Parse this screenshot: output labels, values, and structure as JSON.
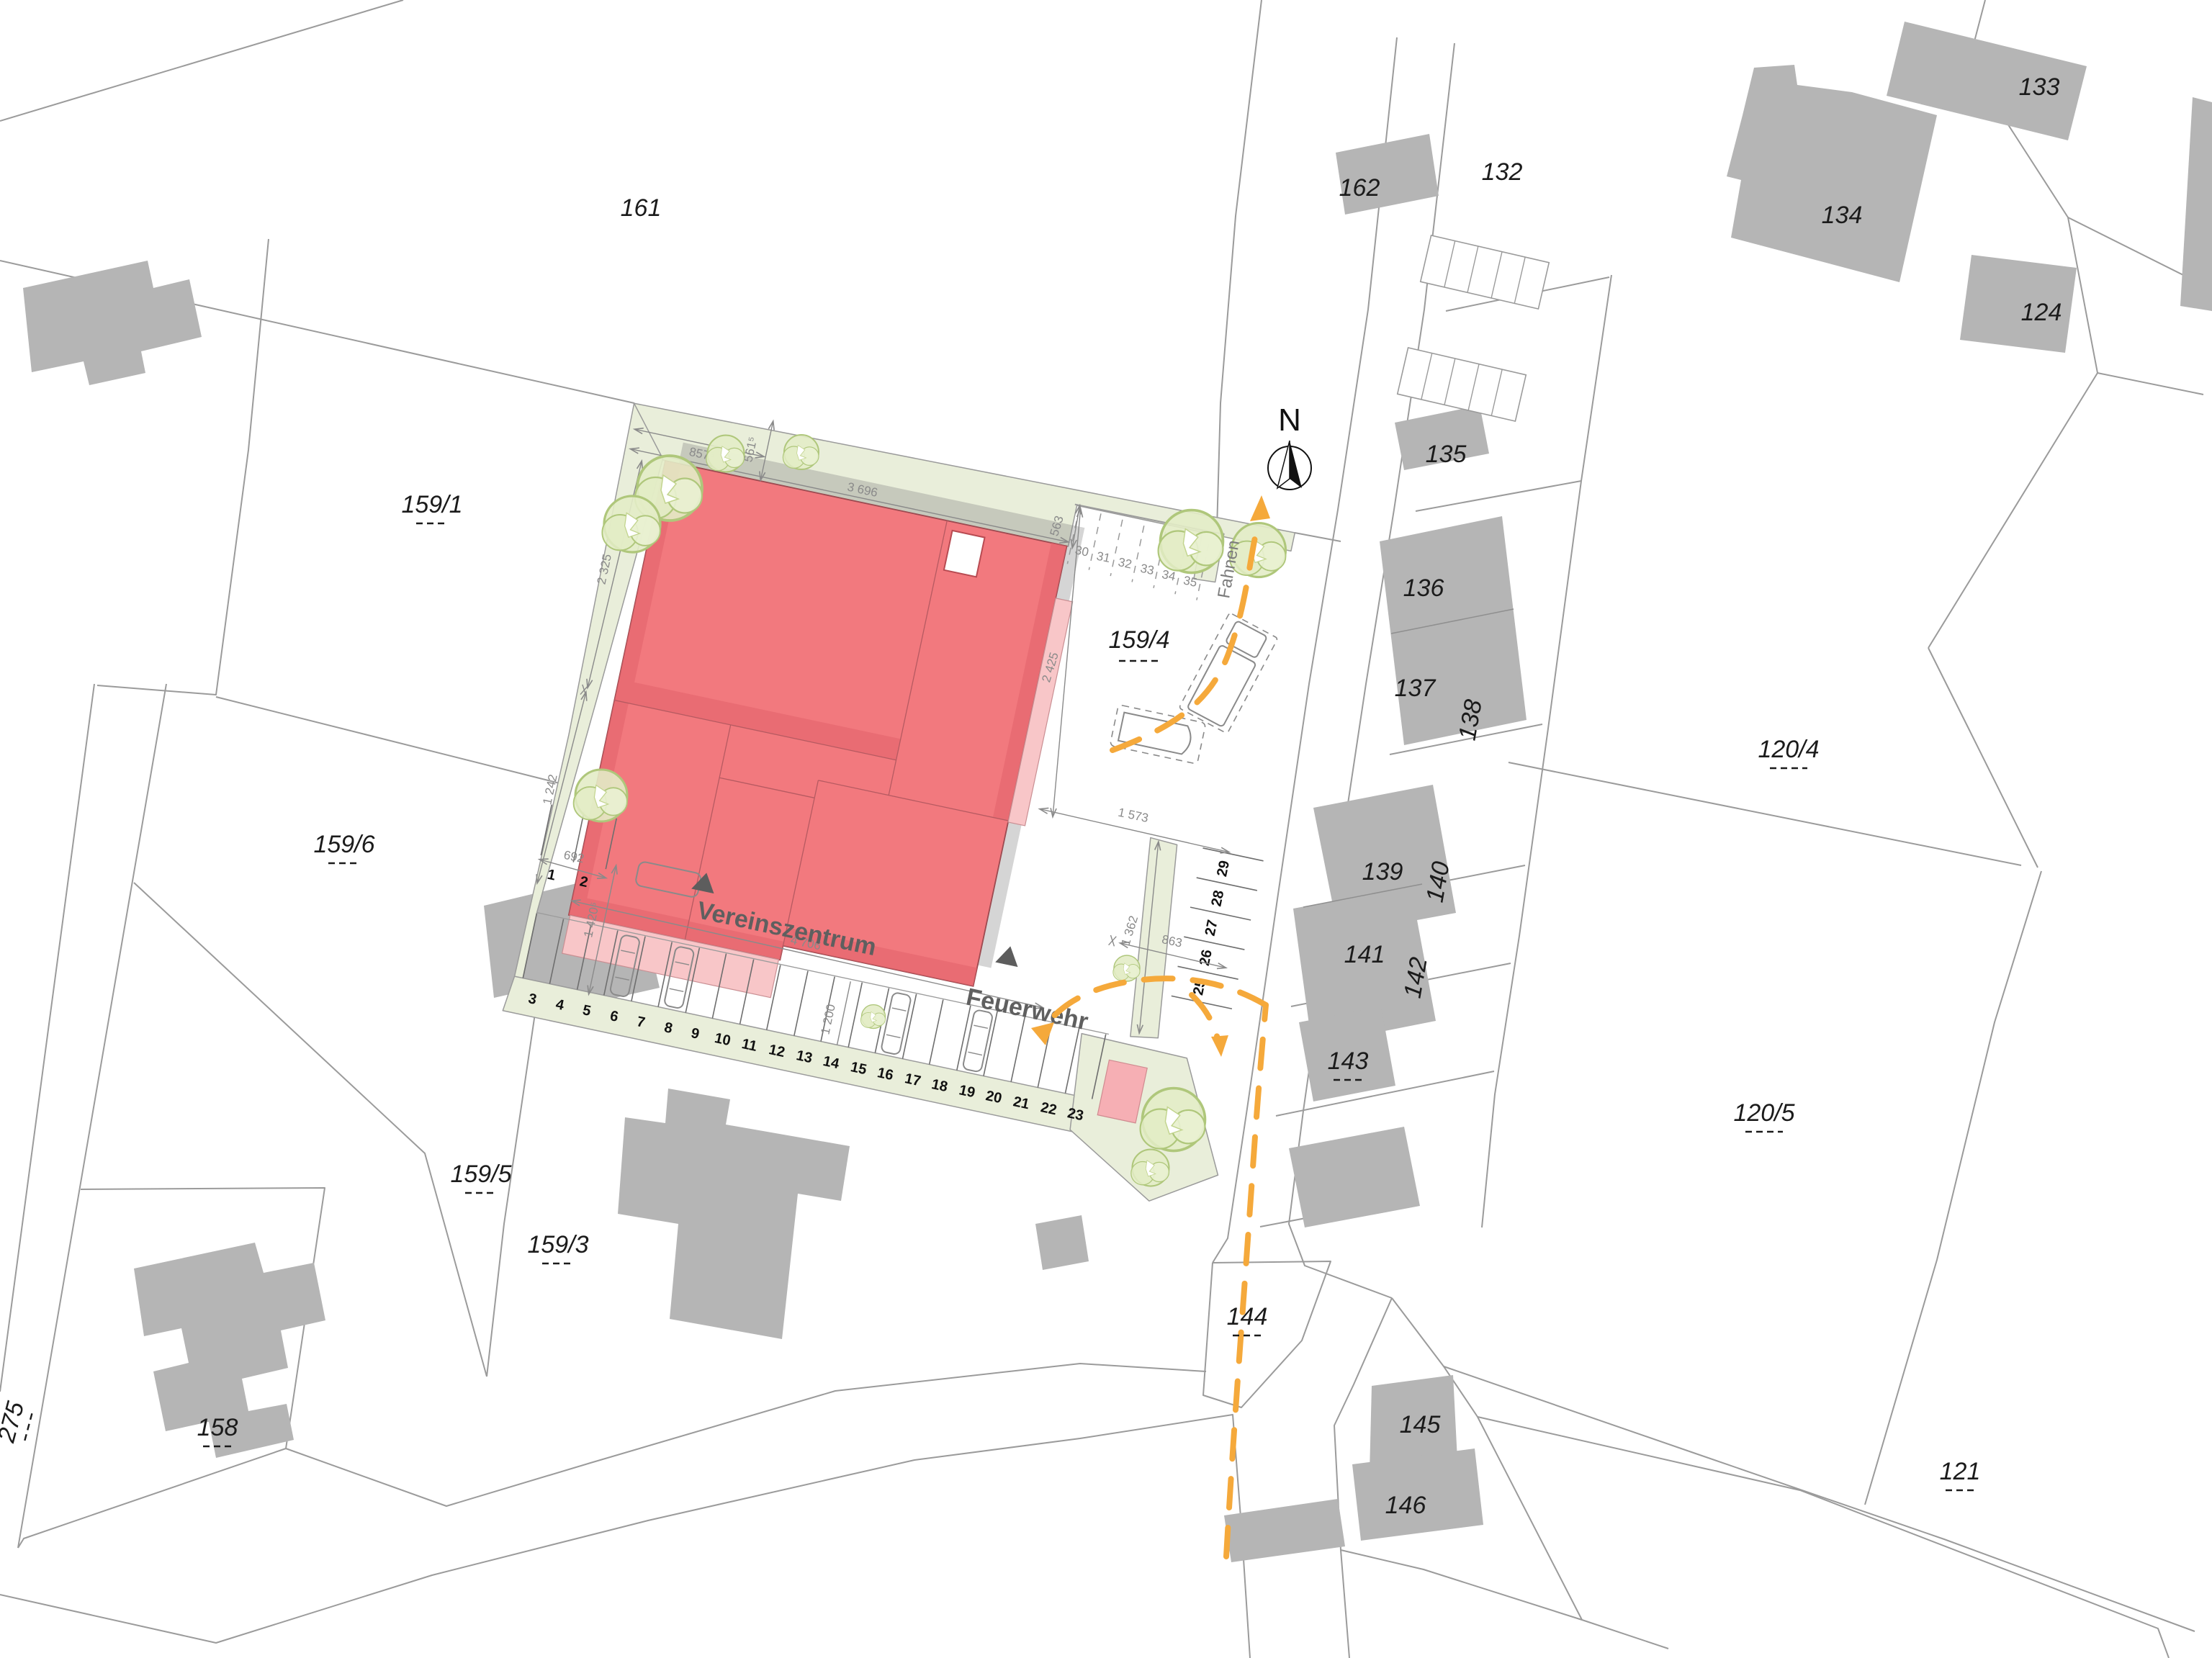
{
  "north": {
    "label": "N"
  },
  "streets": {
    "fahnen": "Fahnen"
  },
  "site": {
    "vereinszentrum": "Vereinszentrum",
    "feuerwehr": "Feuerwehr"
  },
  "parcels": {
    "p161": "161",
    "p159_1": "159/1",
    "p159_4": "159/4",
    "p159_6": "159/6",
    "p159_5": "159/5",
    "p159_3": "159/3",
    "p158": "158",
    "p275": "275",
    "p132": "132",
    "p162": "162",
    "p133": "133",
    "p134": "134",
    "p124": "124",
    "p135": "135",
    "p136": "136",
    "p137": "137",
    "p138": "138",
    "p139": "139",
    "p140": "140",
    "p141": "141",
    "p142": "142",
    "p143": "143",
    "p144": "144",
    "p145": "145",
    "p146": "146",
    "p120_4": "120/4",
    "p120_5": "120/5",
    "p121": "121"
  },
  "dimensions": {
    "top_offset": "857⁵",
    "top_corner": "561⁵",
    "top_width": "3 696",
    "left_upper": "2 325",
    "left_lower": "1 242",
    "west_pair": "692",
    "west_height": "1 420⁵",
    "aisle_length": "4 706",
    "east_gap": "863",
    "ne_corner": "563",
    "east_height": "2 425",
    "se_width": "1 573",
    "east_strip": "1 362",
    "aisle_width": "1 200"
  },
  "parking": {
    "west_pair": [
      "1",
      "2"
    ],
    "south": [
      "3",
      "4",
      "5",
      "6",
      "7",
      "8",
      "9",
      "10",
      "11",
      "12",
      "13",
      "14",
      "15",
      "16",
      "17",
      "18",
      "19",
      "20",
      "21",
      "22",
      "23"
    ],
    "east": [
      "25",
      "26",
      "27",
      "28",
      "29"
    ],
    "northeast": [
      "30",
      "31",
      "32",
      "33",
      "34",
      "35"
    ]
  },
  "colors": {
    "planned_building": "#f2797e",
    "terrace_pink": "#f8c6c8",
    "aux_pink": "#f6afb4",
    "site_green": "#e9eeda",
    "tree_green": "#e3ecc6",
    "existing_building": "#b5b5b5",
    "route_yellow": "#f5a93b",
    "boundary_gray": "#9b9b9b"
  }
}
